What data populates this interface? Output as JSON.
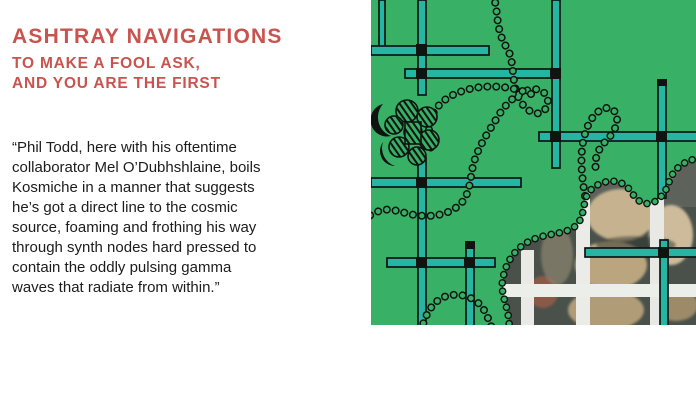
{
  "header": {
    "title": "ASHTRAY NAVIGATIONS",
    "subtitle": "TO MAKE A FOOL ASK,\nAND YOU ARE THE FIRST",
    "accent_color": "#c9534e"
  },
  "review": {
    "quote": "“Phil Todd, here with his oftentime\ncollaborator Mel O’Dubhshlaine, boils\nKosmiche in a manner that suggests\nhe’s got a direct line to the cosmic\nsource, foaming and frothing his way\nthrough synth nodes hard pressed to\ncontain the oddly pulsing gamma\nwaves that radiate from within.”"
  },
  "artwork": {
    "name": "album-cover-art",
    "colors": {
      "green": "#38b166",
      "teal": "#24b6a2",
      "ink": "#0f1410",
      "photo_frame": "#ebece8",
      "photo_dark": "#49514a",
      "photo_beige": "#c6b28e"
    }
  }
}
